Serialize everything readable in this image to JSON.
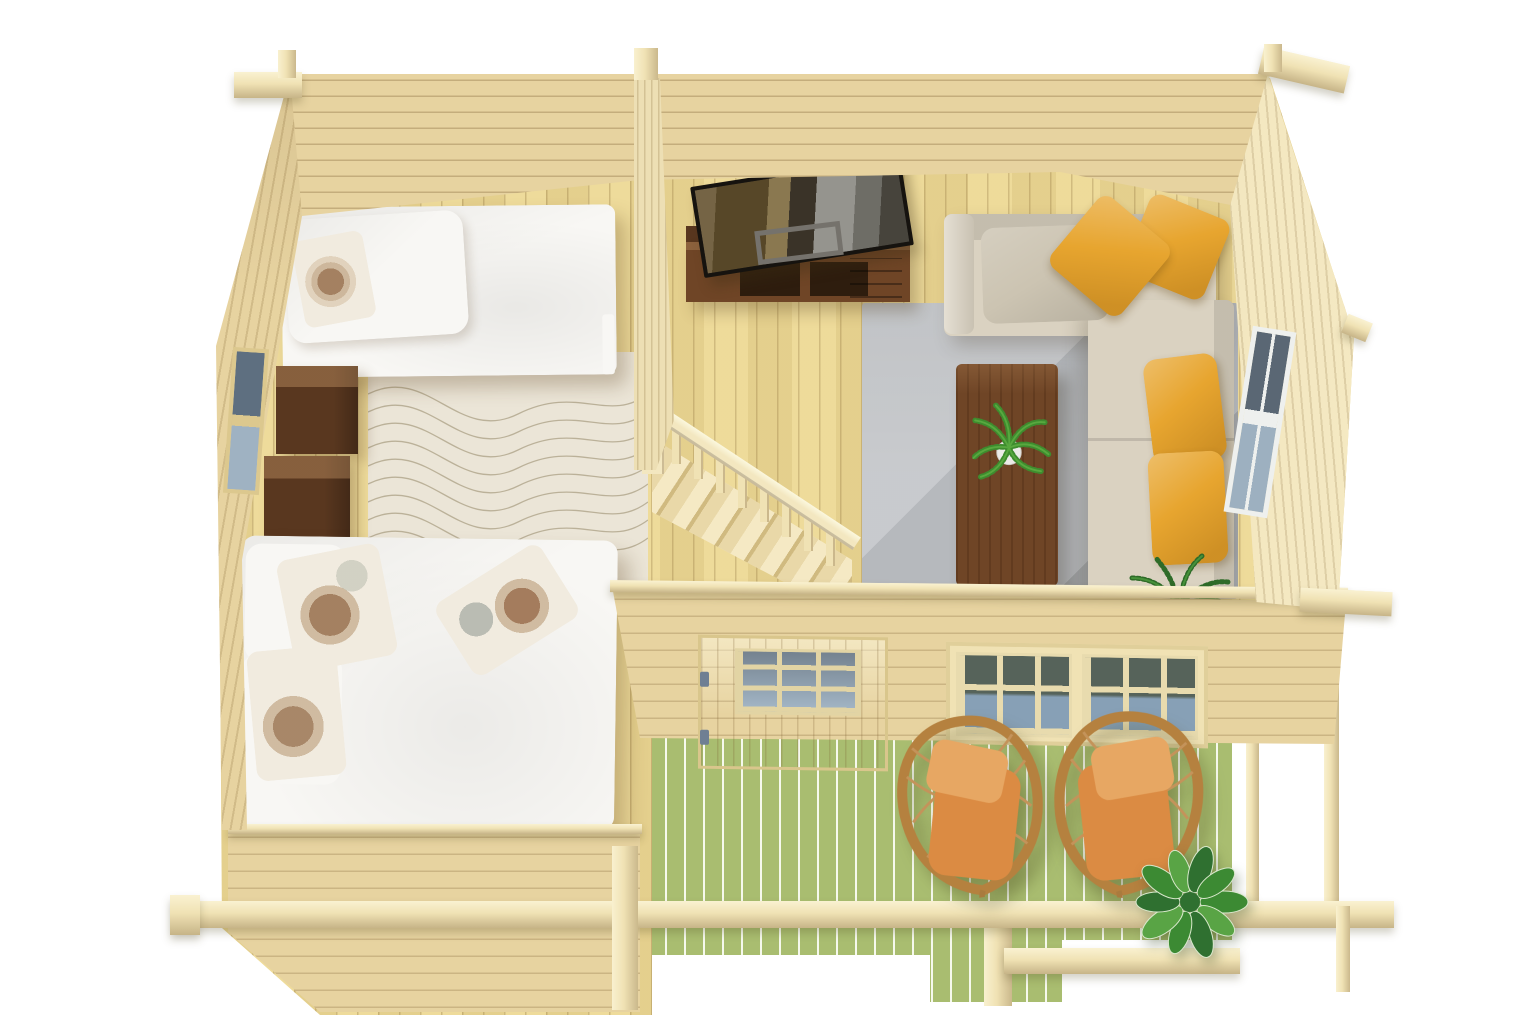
{
  "scene": {
    "title": "Top-down 3D render of a furnished one-storey log cabin with veranda",
    "background": "#ffffff",
    "rooms": [
      {
        "name": "bedroom",
        "position": "left",
        "furniture": [
          "single bed with white duvet and floral pillow",
          "double bed with white duvet and three floral pillows",
          "walnut nightstand",
          "walnut nightstand",
          "beige rug with wavy line pattern"
        ]
      },
      {
        "name": "living-room",
        "position": "right",
        "furniture": [
          "beige corner sofa",
          "two yellow throw pillows",
          "two yellow seat cushions",
          "gray back pillow",
          "walnut coffee table",
          "potted fern",
          "gray rug",
          "walnut tv sideboard",
          "leaning flat-screen tv",
          "gray display frame",
          "corner floor plant"
        ]
      },
      {
        "name": "staircase",
        "position": "center",
        "furniture": [
          "open pine stair flight",
          "handrail with eight balusters",
          "newel post"
        ]
      },
      {
        "name": "terrace",
        "position": "bottom-right",
        "furniture": [
          "rattan hanging chair with orange cushion",
          "rattan hanging chair with orange cushion",
          "leafy potted plant"
        ],
        "features": [
          "green pressure-treated decking",
          "wooden railing with corner posts",
          "front step"
        ]
      }
    ],
    "openings": {
      "front_door": {
        "location": "front wall",
        "glazing": "3x3 pane upper light"
      },
      "front_double_window": {
        "location": "front wall",
        "panes_per_sash": 6
      },
      "left_wall_window": {
        "panes": 2
      },
      "right_wall_window": {
        "panes": 4
      }
    },
    "counts": {
      "beds": 2,
      "nightstands": 2,
      "hanging_chairs": 2,
      "yellow_pillows": 4,
      "floral_pillows": 4,
      "plants": 3,
      "doors": 1,
      "windows": 4
    }
  },
  "palette": {
    "wall_wood": "#e7d3a0",
    "wall_wood_light": "#eddfb4",
    "floor_wood": "#ebd794",
    "beam_wood": "#f0e2b4",
    "stair_wood": "#f3e7c0",
    "deck_green": "#a9bd70",
    "rug_gray": "#b6b9bd",
    "rug_beige": "#ebe5d7",
    "bedding_white": "#f8f7f4",
    "pillow_cream": "#f1ebdf",
    "walnut_dark": "#59371f",
    "walnut_mid": "#6f4526",
    "sofa_beige": "#dad2c1",
    "sofa_pillow_gray": "#ccc4b2",
    "pillow_yellow": "#e7a52f",
    "cushion_orange": "#dc8c44",
    "cushion_orange_light": "#e7a763",
    "wicker_brown": "#b5813f",
    "plant_green": "#47923a",
    "plant_green_dark": "#2e6b28",
    "tv_black": "#2c2824",
    "glass_blue": "#8ba3b8",
    "glass_dark": "#55636f"
  }
}
